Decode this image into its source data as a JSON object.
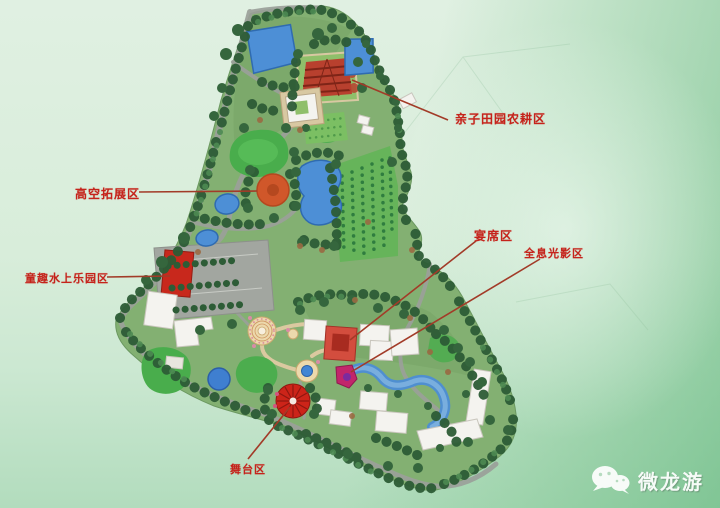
{
  "annotations": {
    "farm_area": {
      "label": "亲子田园农耕区"
    },
    "high_ropes_area": {
      "label": "高空拓展区"
    },
    "kids_water_park_area": {
      "label": "童趣水上乐园区"
    },
    "banquet_area": {
      "label": "宴席区"
    },
    "holographic_light_area": {
      "label": "全息光影区"
    },
    "stage_area": {
      "label": "舞台区"
    }
  },
  "watermark": {
    "text": "微龙游",
    "icon": "wechat-bubbles-icon"
  },
  "map": {
    "type": "resort-master-plan",
    "colors": {
      "annotation_red": "#c5231b",
      "leader_line_red": "#a23b28",
      "water_blue": "#4d8fd6",
      "tree_green": "#2d5c36",
      "lawn_green": "#49ad4c",
      "building_white": "#f4f3ef",
      "landmark_red": "#c8281c",
      "plaza_tan": "#ecd9ac",
      "road_gray": "#9ba09a",
      "background_mint": "#d8eedd"
    }
  }
}
